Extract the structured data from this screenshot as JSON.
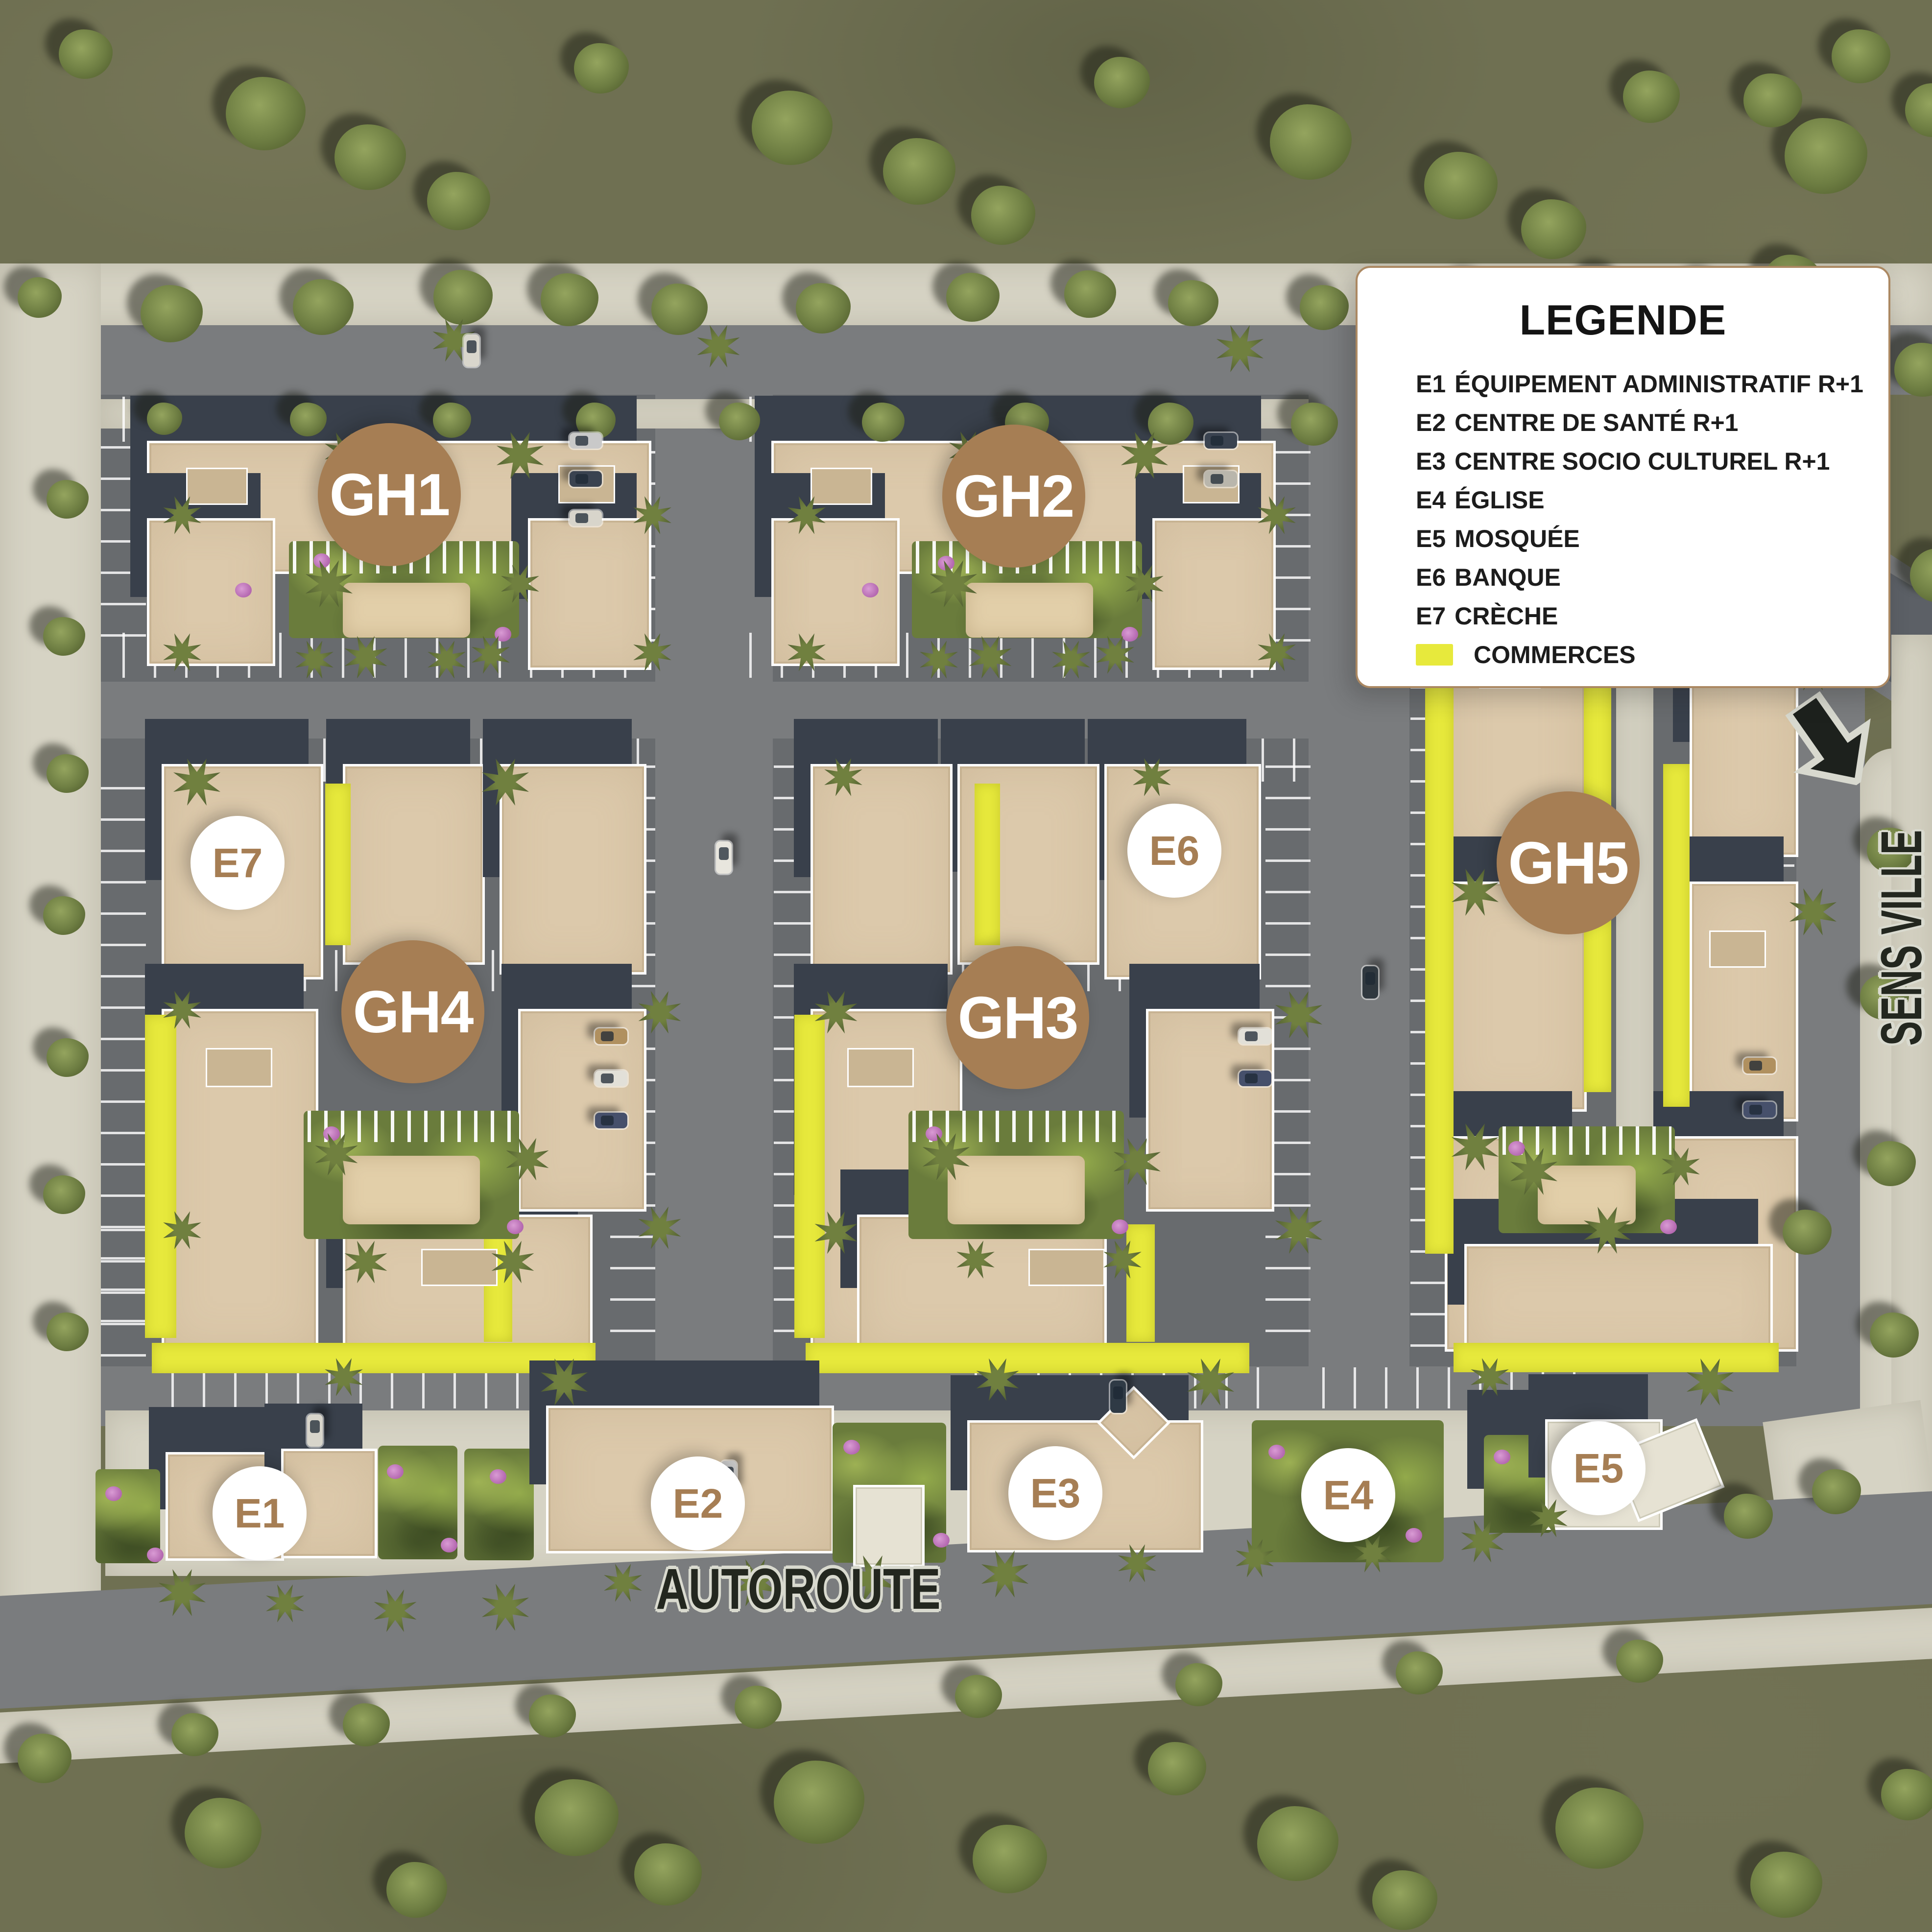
{
  "legend": {
    "title": "LEGENDE",
    "items": [
      {
        "code": "E1",
        "label": "ÉQUIPEMENT ADMINISTRATIF R+1"
      },
      {
        "code": "E2",
        "label": "CENTRE DE SANTÉ R+1"
      },
      {
        "code": "E3",
        "label": "CENTRE SOCIO CULTUREL R+1"
      },
      {
        "code": "E4",
        "label": "ÉGLISE"
      },
      {
        "code": "E5",
        "label": "MOSQUÉE"
      },
      {
        "code": "E6",
        "label": "BANQUE"
      },
      {
        "code": "E7",
        "label": "CRÈCHE"
      }
    ],
    "swatch_label": "COMMERCES"
  },
  "markers": {
    "groups": [
      {
        "id": "gh1",
        "text": "GH1"
      },
      {
        "id": "gh2",
        "text": "GH2"
      },
      {
        "id": "gh3",
        "text": "GH3"
      },
      {
        "id": "gh4",
        "text": "GH4"
      },
      {
        "id": "gh5",
        "text": "GH5"
      }
    ],
    "equipments": [
      {
        "id": "e1",
        "text": "E1"
      },
      {
        "id": "e2",
        "text": "E2"
      },
      {
        "id": "e3",
        "text": "E3"
      },
      {
        "id": "e4",
        "text": "E4"
      },
      {
        "id": "e5",
        "text": "E5"
      },
      {
        "id": "e6",
        "text": "E6"
      },
      {
        "id": "e7",
        "text": "E7"
      }
    ]
  },
  "road_labels": {
    "autoroute": "AUTOROUTE",
    "sens_ville": "SENS VILLE"
  },
  "icons": {
    "direction_arrow": "down-left-bent-arrow"
  },
  "colors": {
    "brand_brown": "#a67e54",
    "commerce_yellow": "#e7e93c",
    "legend_border": "#ab8862",
    "building_beige": "#dcc9ab",
    "road_gray": "#7a7c7e",
    "concrete": "#d6d3c4",
    "grass": "#6f7052",
    "road_label_dark": "#23271f"
  }
}
